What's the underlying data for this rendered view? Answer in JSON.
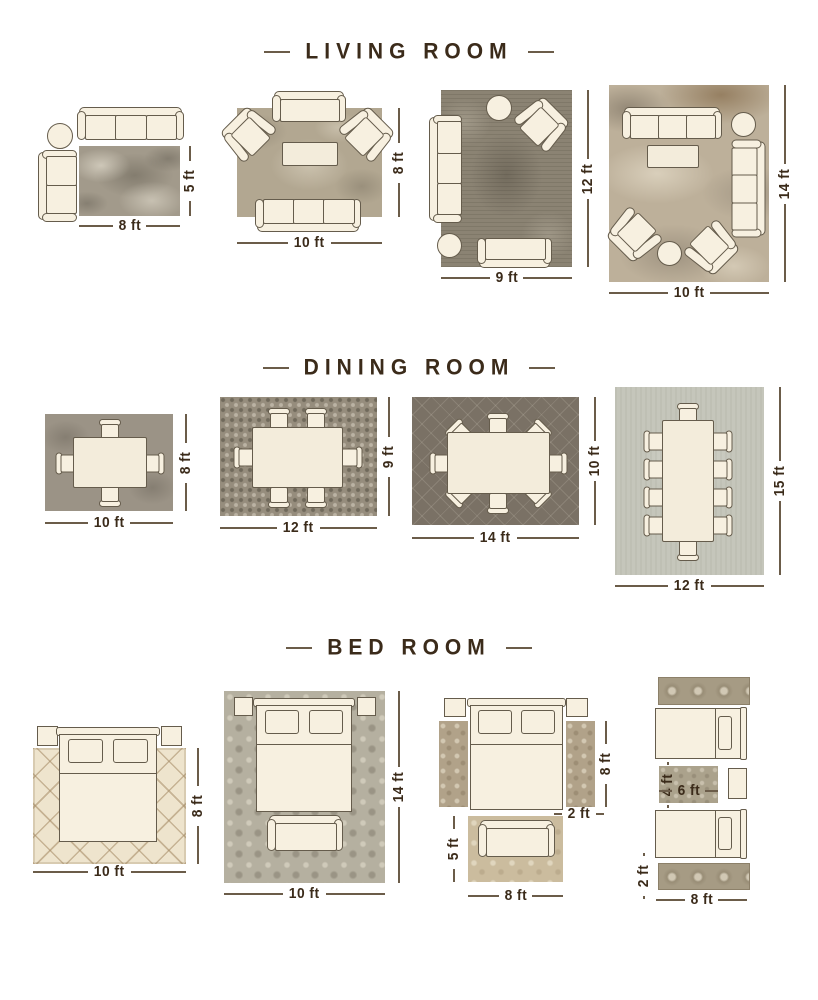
{
  "palette": {
    "title_color": "#3b2b1a",
    "dimension_color": "#3b2b1a",
    "furniture_fill": "#f7f0e0",
    "furniture_outline": "#655c4c",
    "background": "#ffffff"
  },
  "sections": [
    {
      "id": "living-room",
      "title": "LIVING ROOM",
      "layouts": [
        {
          "id": "living-5x8",
          "width_ft": "8 ft",
          "height_ft": "5 ft"
        },
        {
          "id": "living-8x10",
          "width_ft": "10 ft",
          "height_ft": "8 ft"
        },
        {
          "id": "living-9x12",
          "width_ft": "9 ft",
          "height_ft": "12 ft"
        },
        {
          "id": "living-10x14",
          "width_ft": "10 ft",
          "height_ft": "14 ft"
        }
      ]
    },
    {
      "id": "dining-room",
      "title": "DINING ROOM",
      "layouts": [
        {
          "id": "dining-8x10",
          "width_ft": "10 ft",
          "height_ft": "8 ft"
        },
        {
          "id": "dining-9x12",
          "width_ft": "12 ft",
          "height_ft": "9 ft"
        },
        {
          "id": "dining-10x14",
          "width_ft": "14 ft",
          "height_ft": "10 ft"
        },
        {
          "id": "dining-12x15",
          "width_ft": "12 ft",
          "height_ft": "15 ft"
        }
      ]
    },
    {
      "id": "bed-room",
      "title": "BED ROOM",
      "layouts": [
        {
          "id": "bed-8x10",
          "width_ft": "10 ft",
          "height_ft": "8 ft"
        },
        {
          "id": "bed-10x14",
          "width_ft": "10 ft",
          "height_ft": "14 ft"
        },
        {
          "id": "bed-runners",
          "runner_length_ft": "8 ft",
          "runner_width_ft": "2 ft",
          "rug_height_ft": "5 ft",
          "rug_width_ft": "8 ft"
        },
        {
          "id": "bed-twin",
          "accent_height_ft": "4 ft",
          "accent_width_ft": "6 ft",
          "runner_width_ft": "2 ft",
          "runner_length_ft": "8 ft"
        }
      ]
    }
  ]
}
